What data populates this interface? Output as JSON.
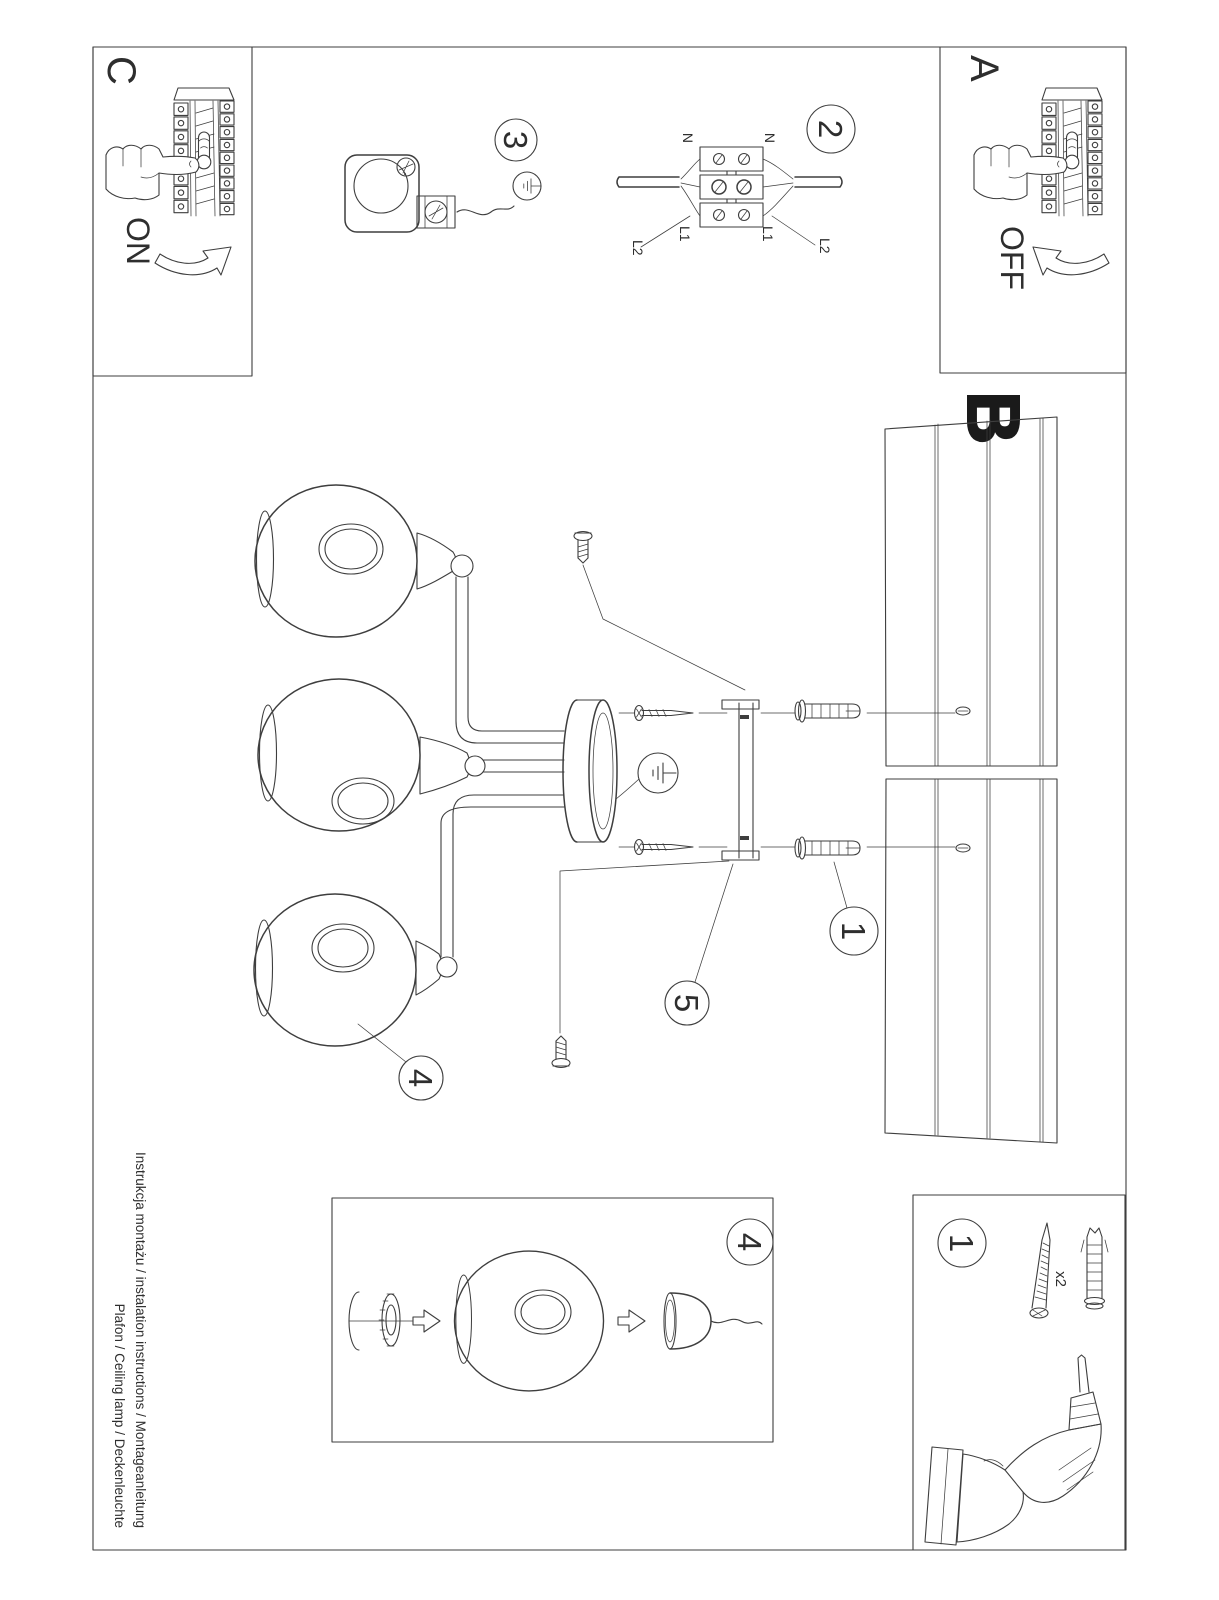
{
  "colors": {
    "ink": "#3e3e3e",
    "paper": "#ffffff",
    "heavy_label": "#1a1a1a"
  },
  "steps": {
    "a": "A",
    "b": "B",
    "c": "C"
  },
  "power": {
    "on": "ON",
    "off": "OFF"
  },
  "callouts": {
    "c1": "1",
    "c2": "2",
    "c3": "3",
    "c4": "4",
    "c5": "5"
  },
  "wiring": {
    "neutral": "N",
    "line1": "L1",
    "line2": "L2"
  },
  "kit": {
    "screw_qty": "x2"
  },
  "footer": {
    "line1": "Instrukcja montażu / instalation instructions / Montageanleitung",
    "line2": "Plafon / Ceiling lamp / Deckenleuchte"
  }
}
